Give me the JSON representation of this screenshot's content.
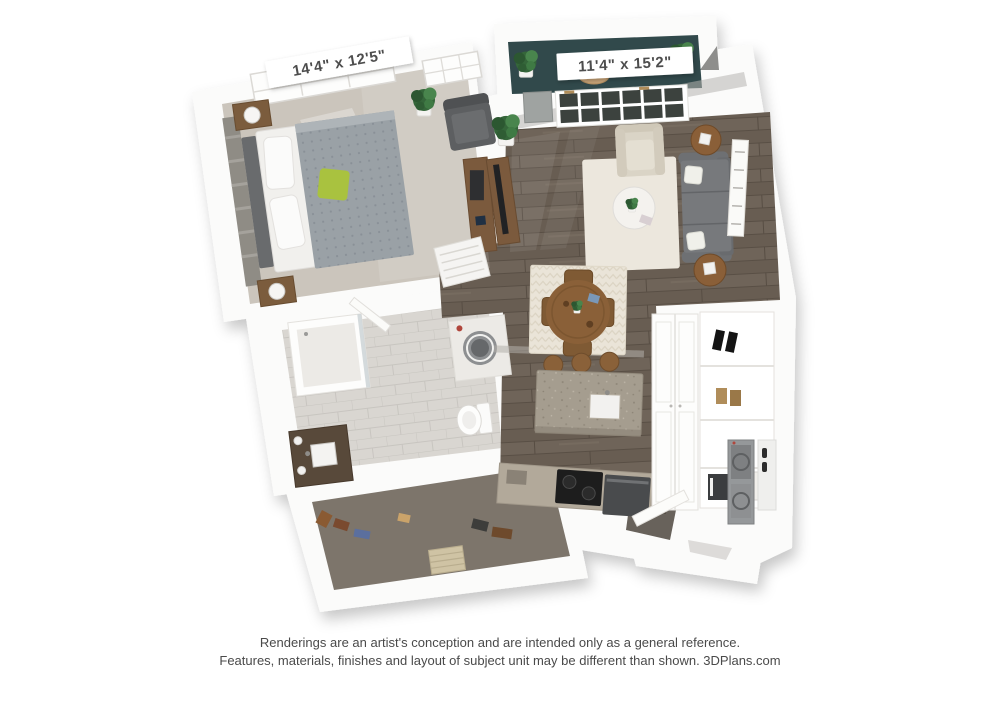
{
  "page": {
    "type": "3D floor plan rendering",
    "background": "#ffffff"
  },
  "floorplan": {
    "bedroom": {
      "dimensions": "14'4\" x 12'5\""
    },
    "living_room": {
      "dimensions": "11'4\" x 15'2\""
    }
  },
  "disclaimer": {
    "line1": "Renderings are an artist's conception and are intended only as a general reference.",
    "line2": "Features, materials, finishes and layout of subject unit may be different than shown. 3DPlans.com"
  },
  "colors": {
    "wall_white": "#fbfbfa",
    "bedroom_carpet": "#cbc5bc",
    "wood_floor": "#6f6459",
    "bathroom_tile": "#d9d6d1",
    "closet_floor": "#7d756b",
    "balcony_floor": "#31494b",
    "sofa_gray": "#77797c",
    "area_rug_cream": "#ece7dd",
    "dining_rug_cream": "#eae4d8",
    "accent_pillow_green": "#a9c23f",
    "wood_furniture": "#8a6038",
    "island_granite": "#a59d8f",
    "label_text": "#4d4d4d",
    "disclaimer_text": "#4a4a4a"
  }
}
